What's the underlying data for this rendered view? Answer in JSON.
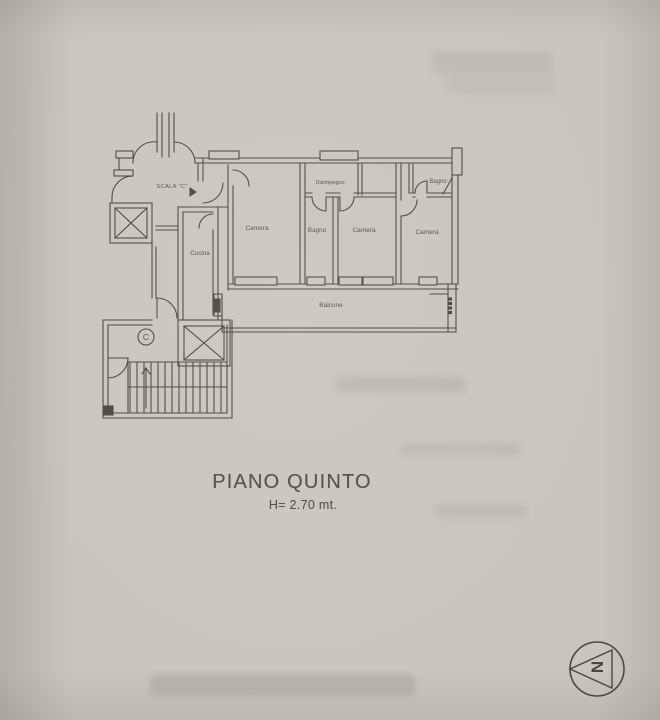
{
  "document": {
    "floor_title": "PIANO QUINTO",
    "ceiling_height": "H= 2.70 mt."
  },
  "floor_plan": {
    "stairwell_label": "SCALA \"C\"",
    "core_label": "C",
    "rooms": [
      {
        "id": "cucina",
        "label": "Cucina"
      },
      {
        "id": "camera-1",
        "label": "Camera"
      },
      {
        "id": "disimpegno",
        "label": "Disimpegno"
      },
      {
        "id": "bagno-1",
        "label": "Bagno"
      },
      {
        "id": "camera-2",
        "label": "Camera"
      },
      {
        "id": "bagno-2",
        "label": "Bagno"
      },
      {
        "id": "camera-3",
        "label": "Camera"
      },
      {
        "id": "balcone",
        "label": "Balcone"
      }
    ]
  },
  "compass": {
    "north_label": "N"
  },
  "colors": {
    "paper": "#c7c6bf",
    "ink": "#4a4843",
    "label_text": "#55534e"
  }
}
